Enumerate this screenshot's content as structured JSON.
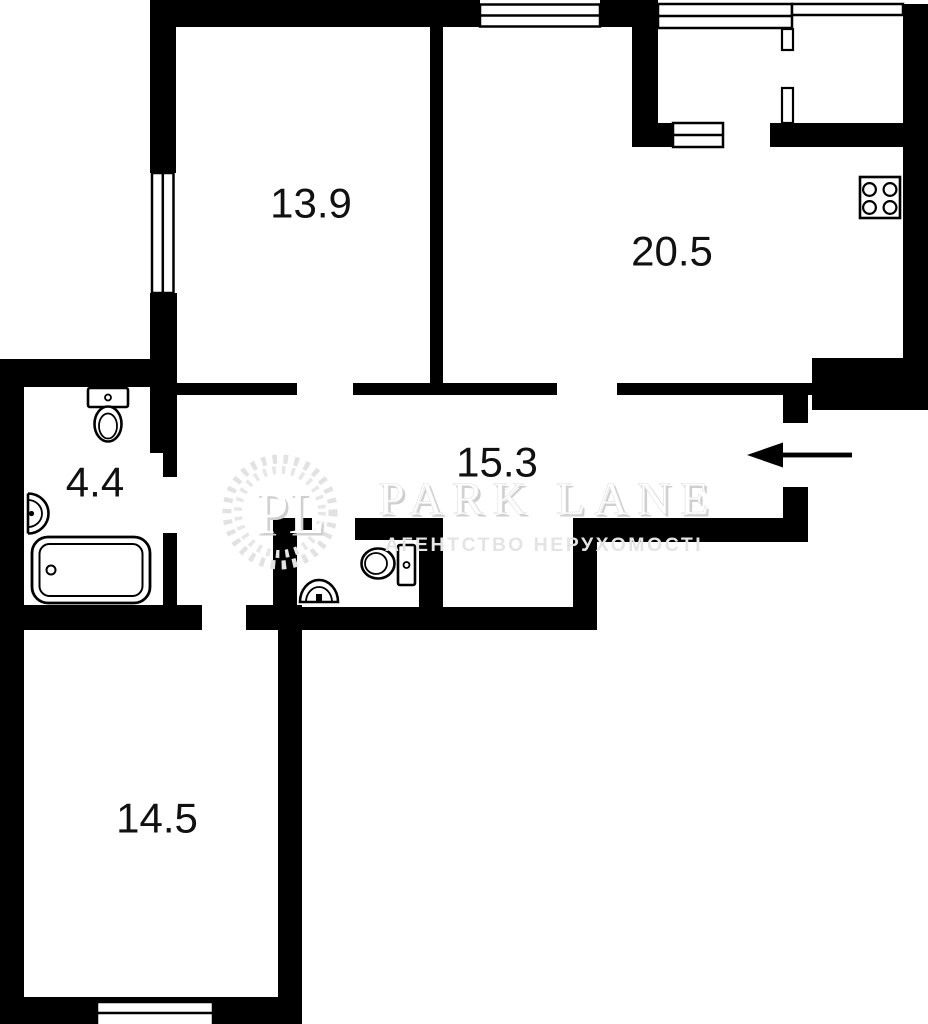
{
  "plan": {
    "type": "apartment-floor-plan",
    "rooms": [
      {
        "id": "room-top-left",
        "area": "13.9"
      },
      {
        "id": "kitchen-living",
        "area": "20.5"
      },
      {
        "id": "hallway",
        "area": "15.3"
      },
      {
        "id": "bathroom",
        "area": "4.4"
      },
      {
        "id": "room-bottom-left",
        "area": "14.5"
      }
    ],
    "fixtures": [
      "toilet",
      "wash-basin",
      "bathtub",
      "stove-4-burner",
      "toilet-small",
      "corner-basin"
    ],
    "entrance_marker": "arrow-left"
  },
  "watermark": {
    "initials": "PL",
    "brand": "PARK LANE",
    "tagline": "АГЕНТСТВО НЕРУХОМОСТІ"
  },
  "colors": {
    "wall": "#000000",
    "background": "#ffffff",
    "label": "#111111",
    "watermark_light": "#e3e3e3",
    "watermark_shadow": "#cfcfcf"
  }
}
